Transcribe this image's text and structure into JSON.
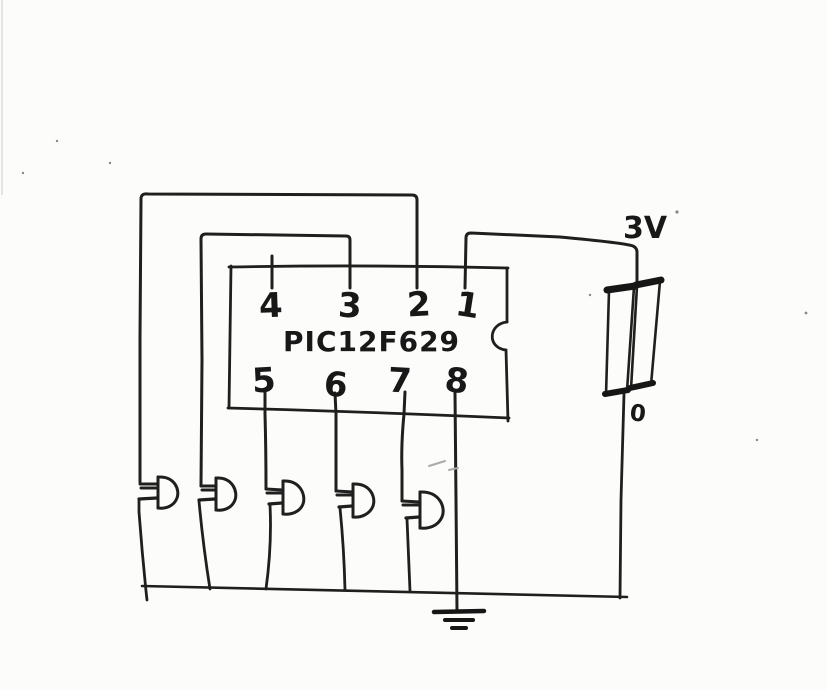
{
  "page": {
    "description": "Hand-drawn circuit schematic scanned on white paper",
    "ink_color": "#1f1f1f",
    "paper_color": "#fcfcfa"
  },
  "chip": {
    "label": "PIC12F629",
    "top_pins": [
      "4",
      "3",
      "2",
      "1"
    ],
    "bottom_pins": [
      "5",
      "6",
      "7",
      "8"
    ]
  },
  "power": {
    "supply_label": "3V",
    "ground_label": "0",
    "battery_cells": 2
  },
  "components": {
    "led_count": 5,
    "ground_symbol": "three-bar earth ground",
    "battery": "two-cell 3V battery"
  },
  "connections": [
    "pin 2 -> outer loop -> LED 1 -> bottom rail",
    "pin 3 -> inner loop -> LED 2 -> bottom rail",
    "pin 5 -> LED 3 -> bottom rail",
    "pin 6 -> LED 4 -> bottom rail",
    "pin 7 -> LED 5 -> bottom rail",
    "pin 8 -> ground symbol",
    "pin 1 -> 3V battery top",
    "battery bottom -> bottom rail"
  ]
}
